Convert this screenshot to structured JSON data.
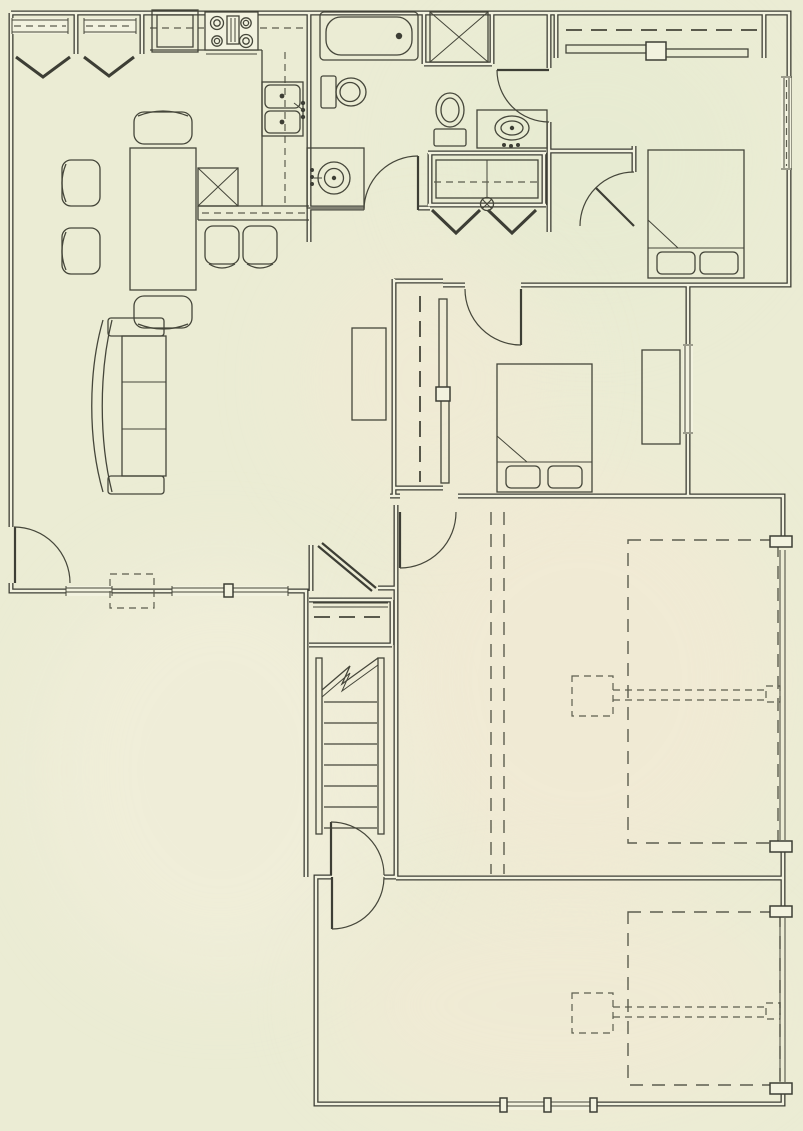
{
  "document": {
    "kind": "architectural-floor-plan",
    "storeys_shown": 1,
    "visible_text": []
  },
  "palette": {
    "paper": "#ebecd4",
    "paper_inner": "#f2f2df",
    "ink": "#3d3e35",
    "ink_thin": "#45463a",
    "dash": "#5c5d4e",
    "patch_warm": "#f5e9d5",
    "patch_cool": "#e4ead0",
    "patch_light": "#f4efdd"
  },
  "plan": {
    "rooms": [
      {
        "name": "dining-area",
        "features": [
          "bay-window",
          "bay-window",
          "dining-table",
          "armchair",
          "armchair",
          "armchair",
          "armchair"
        ]
      },
      {
        "name": "kitchen",
        "features": [
          "refrigerator",
          "range-stove",
          "double-sink",
          "upper-cabinet-dashed",
          "peninsula-counter",
          "dishwasher-x",
          "bar-stool",
          "bar-stool"
        ]
      },
      {
        "name": "bathroom-1",
        "features": [
          "bathtub",
          "toilet",
          "round-vanity-sink",
          "swing-door"
        ]
      },
      {
        "name": "bathroom-2",
        "features": [
          "shower-stall",
          "toilet",
          "vanity-sink",
          "swing-door"
        ]
      },
      {
        "name": "hall-closet",
        "features": [
          "shelf-dashed",
          "ceiling-light",
          "bifold-doors",
          "bifold-doors"
        ]
      },
      {
        "name": "bedroom-1",
        "features": [
          "bed",
          "pillow",
          "pillow",
          "sliding-door-closet",
          "closet-rod-dashed",
          "window",
          "swing-door"
        ]
      },
      {
        "name": "bedroom-2",
        "features": [
          "bed",
          "pillow",
          "pillow",
          "dresser",
          "sliding-door-closet",
          "closet-rod-dashed",
          "window",
          "swing-door"
        ]
      },
      {
        "name": "living-room",
        "features": [
          "curved-sofa",
          "media-console",
          "entry-door",
          "window",
          "window"
        ]
      },
      {
        "name": "stair-hall",
        "features": [
          "staircase",
          "break-line",
          "linen-closet",
          "closet-rod-dashed",
          "swing-door",
          "swing-door"
        ]
      },
      {
        "name": "garage-bay-1",
        "features": [
          "overhead-door-dashed",
          "garage-door-opener",
          "opener-rail-dashed",
          "ceiling-beam-dashed",
          "ceiling-beam-dashed"
        ]
      },
      {
        "name": "garage-bay-2",
        "features": [
          "overhead-door-dashed",
          "garage-door-opener",
          "opener-rail-dashed",
          "window"
        ]
      }
    ],
    "stairs": {
      "tread_count": 7,
      "has_break_line": true
    },
    "counts": {
      "swing_doors": 9,
      "bifold_pairs": 2,
      "bay_windows": 2,
      "beds": 2,
      "garage_bays": 2
    }
  }
}
